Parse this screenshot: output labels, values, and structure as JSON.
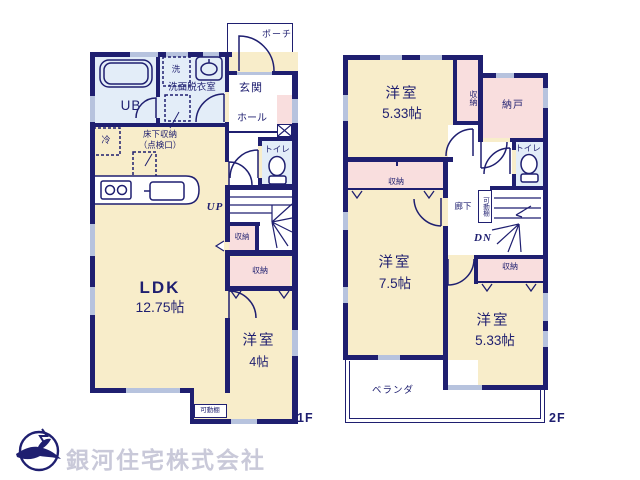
{
  "floor1": {
    "floor_label": "1F",
    "porch": "ポーチ",
    "entrance": "玄関",
    "hall": "ホール",
    "toilet": "トイレ",
    "unit_bath": "UB",
    "washer": "洗",
    "washroom": "洗面脱衣室",
    "fridge": "冷",
    "underfloor_storage": "床下収納",
    "underfloor_hatch": "（点検口）",
    "ldk_name": "LDK",
    "ldk_size": "12.75帖",
    "stairs_up": "UP",
    "stair_closet": "収納",
    "bedroom_closet": "収納",
    "bedroom_name": "洋室",
    "bedroom_size": "4帖",
    "movable_shelf": "可動棚"
  },
  "floor2": {
    "floor_label": "2F",
    "bedroom_north_name": "洋室",
    "bedroom_north_size": "5.33帖",
    "closet_north": "収納",
    "storeroom": "納戸",
    "toilet": "トイレ",
    "bedroom_west_closet": "収納",
    "hallway": "廊下",
    "movable_shelf": "可動棚",
    "stairs_down": "DN",
    "bedroom_east_closet": "収納",
    "bedroom_west_name": "洋室",
    "bedroom_west_size": "7.5帖",
    "bedroom_east_name": "洋室",
    "bedroom_east_size": "5.33帖",
    "veranda": "ベランダ"
  },
  "company": {
    "name": "銀河住宅株式会社"
  },
  "colors": {
    "wall_navy": "#1f1f70",
    "room_cream": "#f8edca",
    "closet_pink": "#f9dede",
    "wet_area_blue": "#e3edf8",
    "window_gray": "#b7c3de",
    "company_text_gray": "#c9c9d9"
  }
}
